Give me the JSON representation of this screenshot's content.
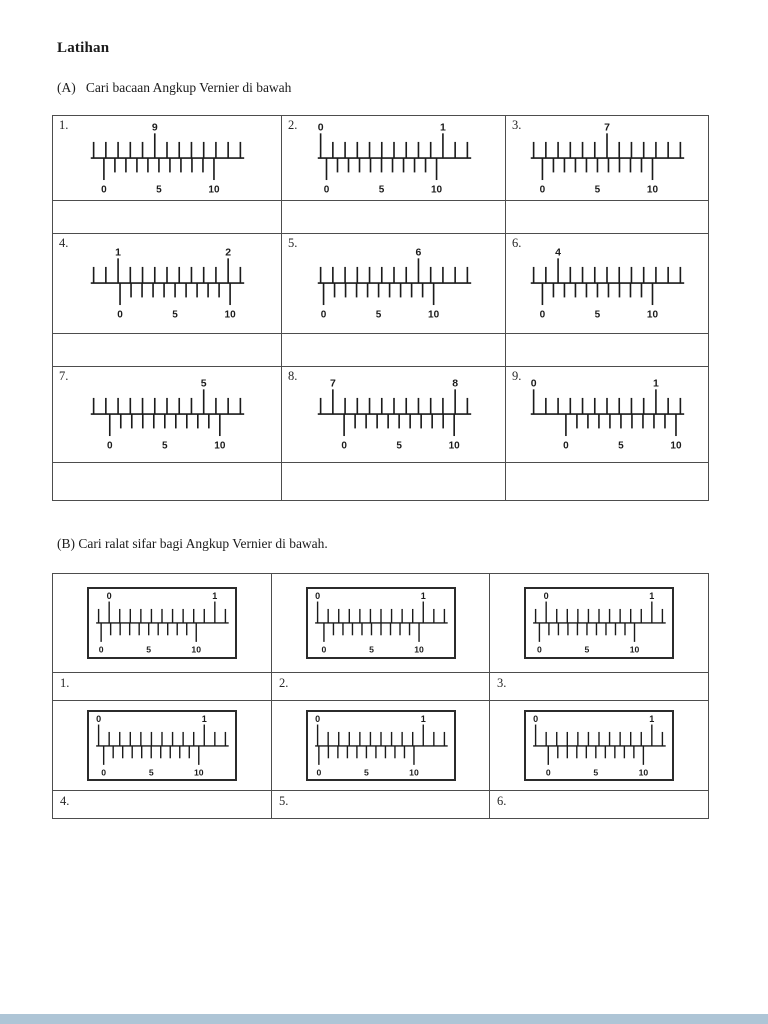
{
  "page": {
    "title": "Latihan",
    "section_a_heading": "(A)   Cari bacaan Angkup Vernier di bawah",
    "section_b_heading": "(B) Cari ralat sifar bagi Angkup Vernier di bawah."
  },
  "colors": {
    "ink": "#1b1b1b",
    "table_border": "#4d4d4d",
    "bottom_bar": "#aec5d6"
  },
  "vernier_labels": [
    "0",
    "5",
    "10"
  ],
  "section_a": {
    "items": [
      {
        "num": "1.",
        "main_labels": [
          {
            "text": "9",
            "tick": 5
          }
        ],
        "vernier_start": 0.07
      },
      {
        "num": "2.",
        "main_labels": [
          {
            "text": "0",
            "tick": 0
          },
          {
            "text": "1",
            "tick": 10
          }
        ],
        "vernier_start": 0.04
      },
      {
        "num": "3.",
        "main_labels": [
          {
            "text": "7",
            "tick": 6
          }
        ],
        "vernier_start": 0.06
      },
      {
        "num": "4.",
        "main_labels": [
          {
            "text": "1",
            "tick": 2
          },
          {
            "text": "2",
            "tick": 11
          }
        ],
        "vernier_start": 0.18
      },
      {
        "num": "5.",
        "main_labels": [
          {
            "text": "6",
            "tick": 8
          }
        ],
        "vernier_start": 0.02
      },
      {
        "num": "6.",
        "main_labels": [
          {
            "text": "4",
            "tick": 2
          }
        ],
        "vernier_start": 0.06
      },
      {
        "num": "7.",
        "main_labels": [
          {
            "text": "5",
            "tick": 9
          }
        ],
        "vernier_start": 0.11
      },
      {
        "num": "8.",
        "main_labels": [
          {
            "text": "7",
            "tick": 1
          },
          {
            "text": "8",
            "tick": 11
          }
        ],
        "vernier_start": 0.16
      },
      {
        "num": "9.",
        "main_labels": [
          {
            "text": "0",
            "tick": 0
          },
          {
            "text": "1",
            "tick": 10
          }
        ],
        "vernier_start": 0.22
      }
    ]
  },
  "section_b": {
    "items": [
      {
        "num": "1.",
        "main_labels": [
          {
            "text": "0",
            "tick": 1
          },
          {
            "text": "1",
            "tick": 11
          }
        ],
        "vernier_start": 0.02
      },
      {
        "num": "2.",
        "main_labels": [
          {
            "text": "0",
            "tick": 0
          },
          {
            "text": "1",
            "tick": 10
          }
        ],
        "vernier_start": 0.05
      },
      {
        "num": "3.",
        "main_labels": [
          {
            "text": "0",
            "tick": 1
          },
          {
            "text": "1",
            "tick": 11
          }
        ],
        "vernier_start": 0.03
      },
      {
        "num": "4.",
        "main_labels": [
          {
            "text": "0",
            "tick": 0
          },
          {
            "text": "1",
            "tick": 10
          }
        ],
        "vernier_start": 0.04
      },
      {
        "num": "5.",
        "main_labels": [
          {
            "text": "0",
            "tick": 0
          },
          {
            "text": "1",
            "tick": 10
          }
        ],
        "vernier_start": 0.01
      },
      {
        "num": "6.",
        "main_labels": [
          {
            "text": "0",
            "tick": 0
          },
          {
            "text": "1",
            "tick": 11
          }
        ],
        "vernier_start": 0.1
      }
    ]
  }
}
